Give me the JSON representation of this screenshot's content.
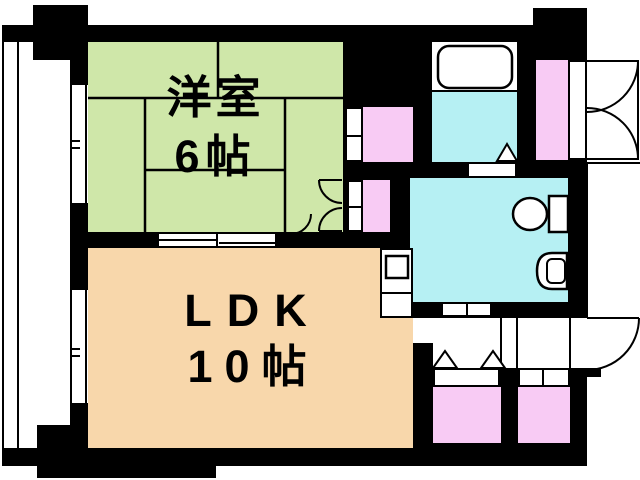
{
  "rooms": [
    {
      "name": "洋室",
      "size": "6帖",
      "color": "#cfe7a9"
    },
    {
      "name": "LDK",
      "size": "10帖",
      "color": "#f8d7ab"
    }
  ],
  "zones": [
    {
      "name": "bathroom",
      "color": "#b6f0f3"
    },
    {
      "name": "toilet-washroom",
      "color": "#b6f0f3"
    },
    {
      "name": "closet",
      "color": "#f8cbf4"
    },
    {
      "name": "balcony",
      "color": "#ffffff"
    },
    {
      "name": "entrance-hall",
      "color": "#ffffff"
    }
  ],
  "colors": {
    "wall": "#000000",
    "room1": "#cfe7a9",
    "room2": "#f8d7ab",
    "water": "#b6f0f3",
    "closet": "#f8cbf4",
    "bg": "#ffffff"
  },
  "fixtures": [
    "bathtub",
    "toilet",
    "washbasin",
    "kitchen-sink"
  ]
}
